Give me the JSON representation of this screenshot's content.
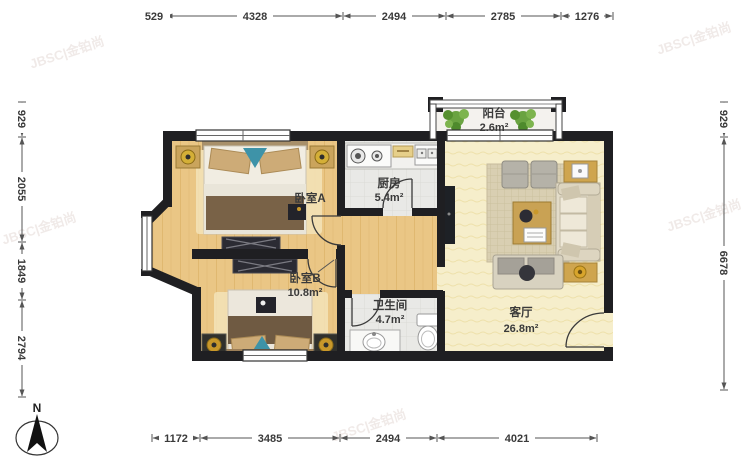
{
  "compass": {
    "label": "N"
  },
  "watermark": {
    "text": "JBSC|金铂尚"
  },
  "dimensions": {
    "top": [
      "529",
      "4328",
      "2494",
      "2785",
      "1276"
    ],
    "bottom": [
      "1172",
      "3485",
      "2494",
      "4021"
    ],
    "left": [
      "929",
      "2055",
      "1849",
      "2794"
    ],
    "right": [
      "929",
      "6678"
    ]
  },
  "rooms": {
    "bedroomA": {
      "name": "卧室A",
      "area": ""
    },
    "bedroomB": {
      "name": "卧室B",
      "area": "10.8m²"
    },
    "kitchen": {
      "name": "厨房",
      "area": "5.4m²"
    },
    "bathroom": {
      "name": "卫生间",
      "area": "4.7m²"
    },
    "living": {
      "name": "客厅",
      "area": "26.8m²"
    },
    "balcony": {
      "name": "阳台",
      "area": "2.6m²"
    }
  },
  "colors": {
    "wall": "#1f1f22",
    "wood_floor": "#eac685",
    "living_floor": "#f6eecb",
    "tile_floor": "#e9e9e6",
    "accent_wood": "#c9a254",
    "plant_green": "#6aa341"
  }
}
